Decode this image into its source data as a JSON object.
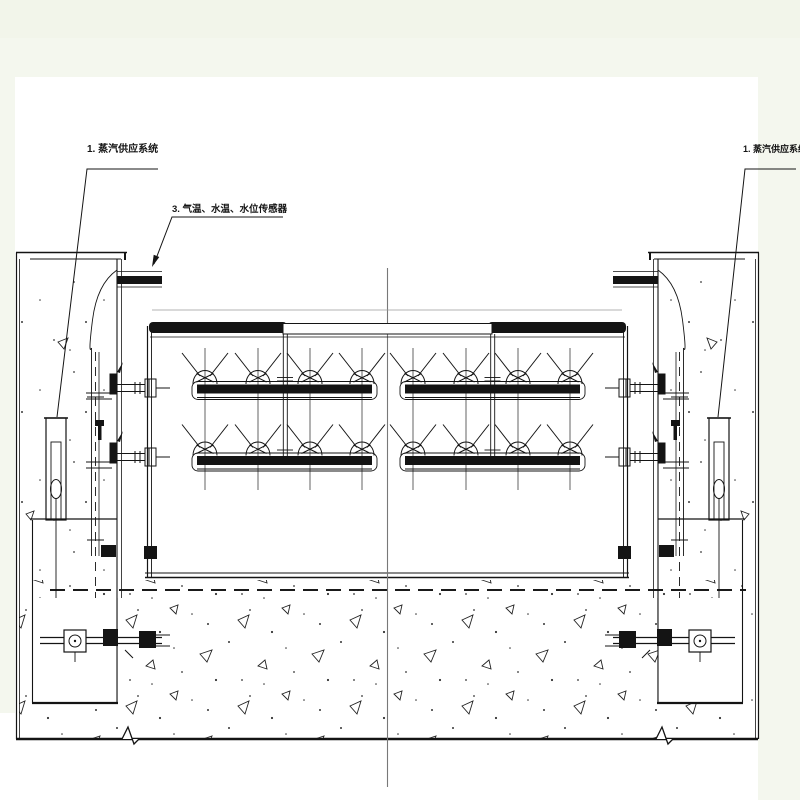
{
  "drawing": {
    "labels": {
      "steam_supply_left": "1. 蒸汽供应系统",
      "sensors": "3. 气温、水温、水位传感器",
      "steam_supply_right": "1. 蒸汽供应系统"
    },
    "colors": {
      "paper": "#ffffff",
      "margin_tint": "#f4f7ee",
      "ink": "#141414",
      "center_line": "#787878"
    }
  }
}
